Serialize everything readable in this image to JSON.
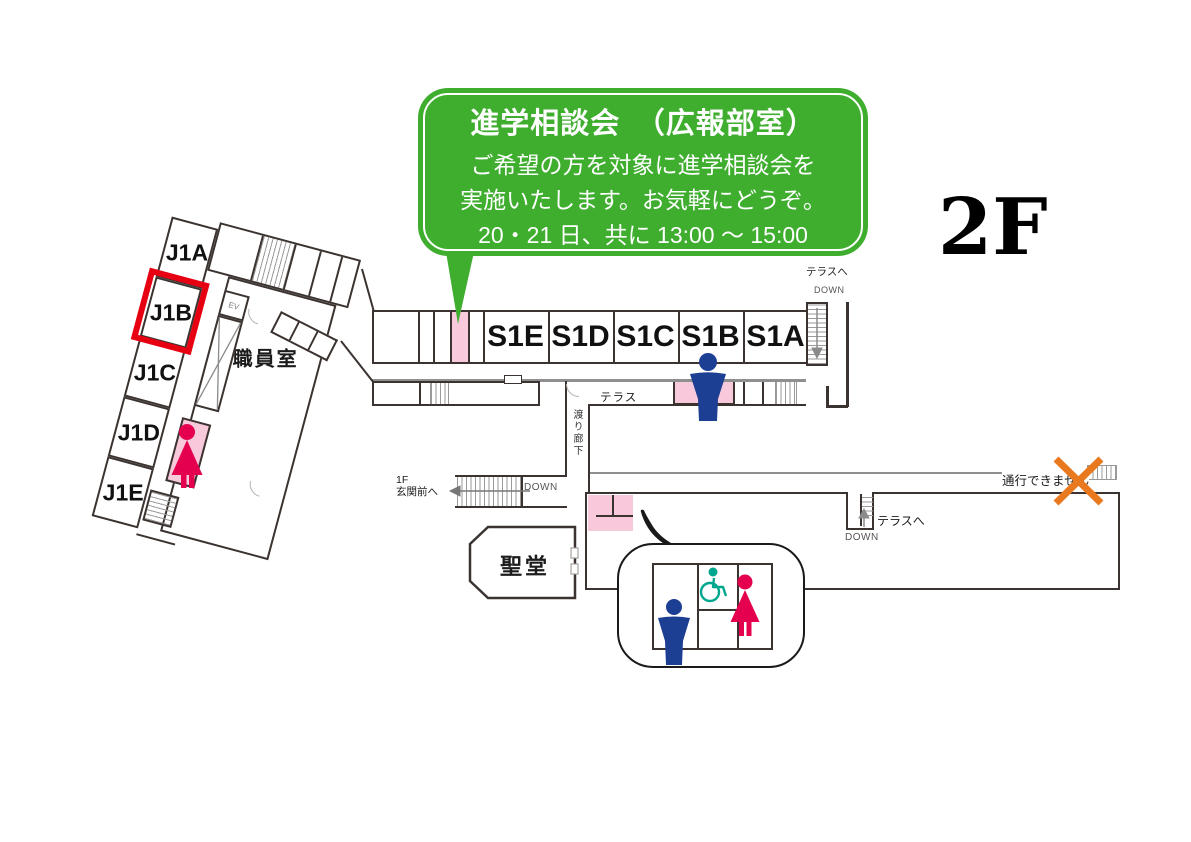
{
  "floor_label": "2F",
  "callout": {
    "title": "進学相談会　（広報部室）",
    "line1": "ご希望の方を対象に進学相談会を",
    "line2": "実施いたします。お気軽にどうぞ。",
    "line3": "20・21 日、共に 13:00 ～ 15:00"
  },
  "left_wing": {
    "rooms": [
      "J1A",
      "J1B",
      "J1C",
      "J1D",
      "J1E"
    ],
    "highlighted_room": "J1B",
    "staff_room_label": "職員室",
    "elevator_label": "EV"
  },
  "main_wing": {
    "rooms": [
      "S1E",
      "S1D",
      "S1C",
      "S1B",
      "S1A"
    ]
  },
  "labels": {
    "terrace": "テラス",
    "to_terrace": "テラスへ",
    "down": "DOWN",
    "crossing_corridor": "渡り廊下",
    "entrance_line1": "1F",
    "entrance_line2": "玄関前へ",
    "no_passage": "通行できません",
    "chapel": "聖堂"
  },
  "colors": {
    "callout_green": "#3fae2f",
    "room_pink": "#f8c8db",
    "highlight_red": "#e60012",
    "mens_navy": "#1c3e93",
    "womens_crimson": "#e5004f",
    "wheelchair_teal": "#00a78e",
    "no_passage_orange": "#e8791e",
    "wall_dark": "#3b3330"
  }
}
